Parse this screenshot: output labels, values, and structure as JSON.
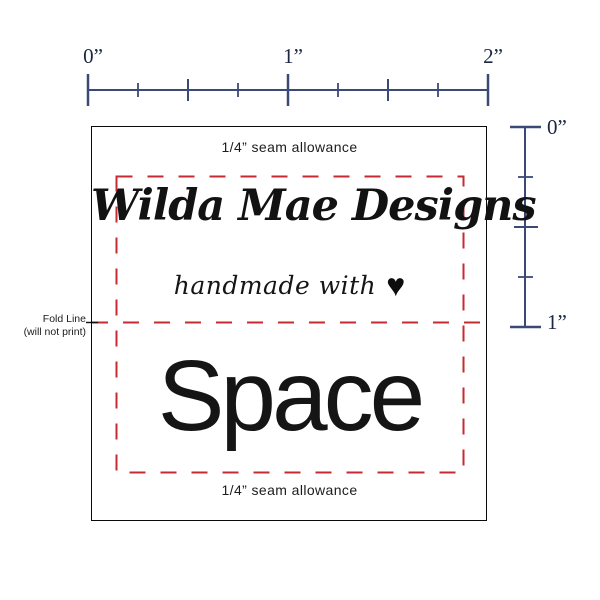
{
  "colors": {
    "ruler": "#3a4a75",
    "red": "#c62a33",
    "ink": "#161616"
  },
  "rulers": {
    "horizontal": {
      "labels": [
        "0”",
        "1”",
        "2”"
      ]
    },
    "vertical": {
      "labels": [
        "0”",
        "1”"
      ]
    }
  },
  "label": {
    "seam_top": "1/4” seam allowance",
    "brand": "Wilda Mae Designs",
    "tagline": "handmade with",
    "heart": "♥",
    "main_text": "Space",
    "seam_bottom": "1/4” seam allowance"
  },
  "fold_note": {
    "line1": "Fold Line",
    "line2": "(will not print)"
  }
}
